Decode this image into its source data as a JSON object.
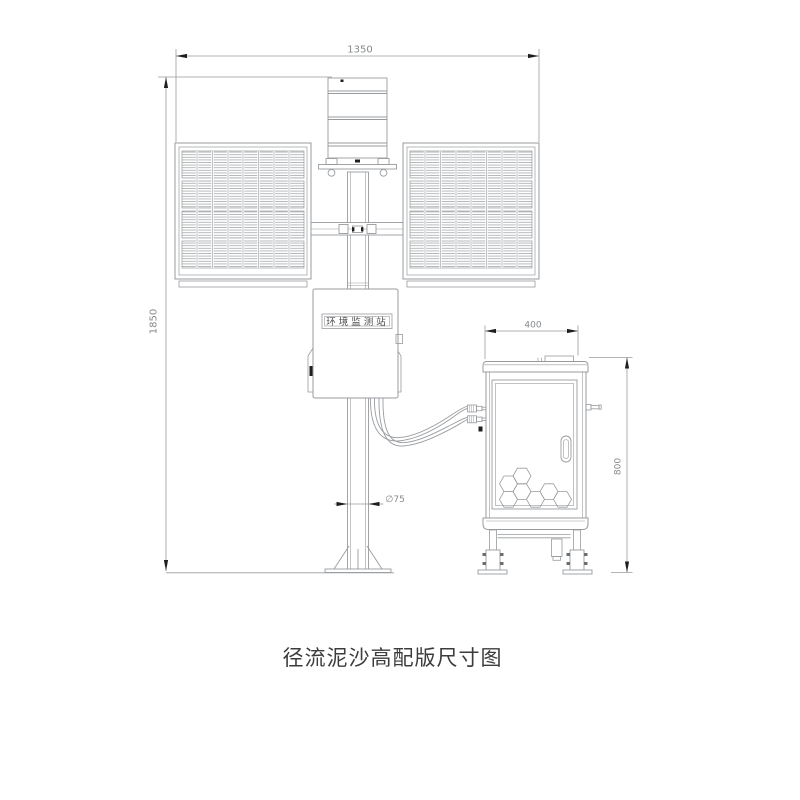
{
  "caption": "径流泥沙高配版尺寸图",
  "dimensions": {
    "station_width": "1350",
    "station_height": "1850",
    "pole_diameter": "∅75",
    "cabinet_width": "400",
    "cabinet_height": "800"
  },
  "station": {
    "control_box_nameplate": "环境监测站"
  },
  "colors": {
    "line": "#989b9e",
    "line_dark": "#707477",
    "hatch": "#b0b3b5",
    "arrow_black": "#1f1f1f",
    "dim_text": "#86898c",
    "caption_text": "#3c3c3c"
  }
}
